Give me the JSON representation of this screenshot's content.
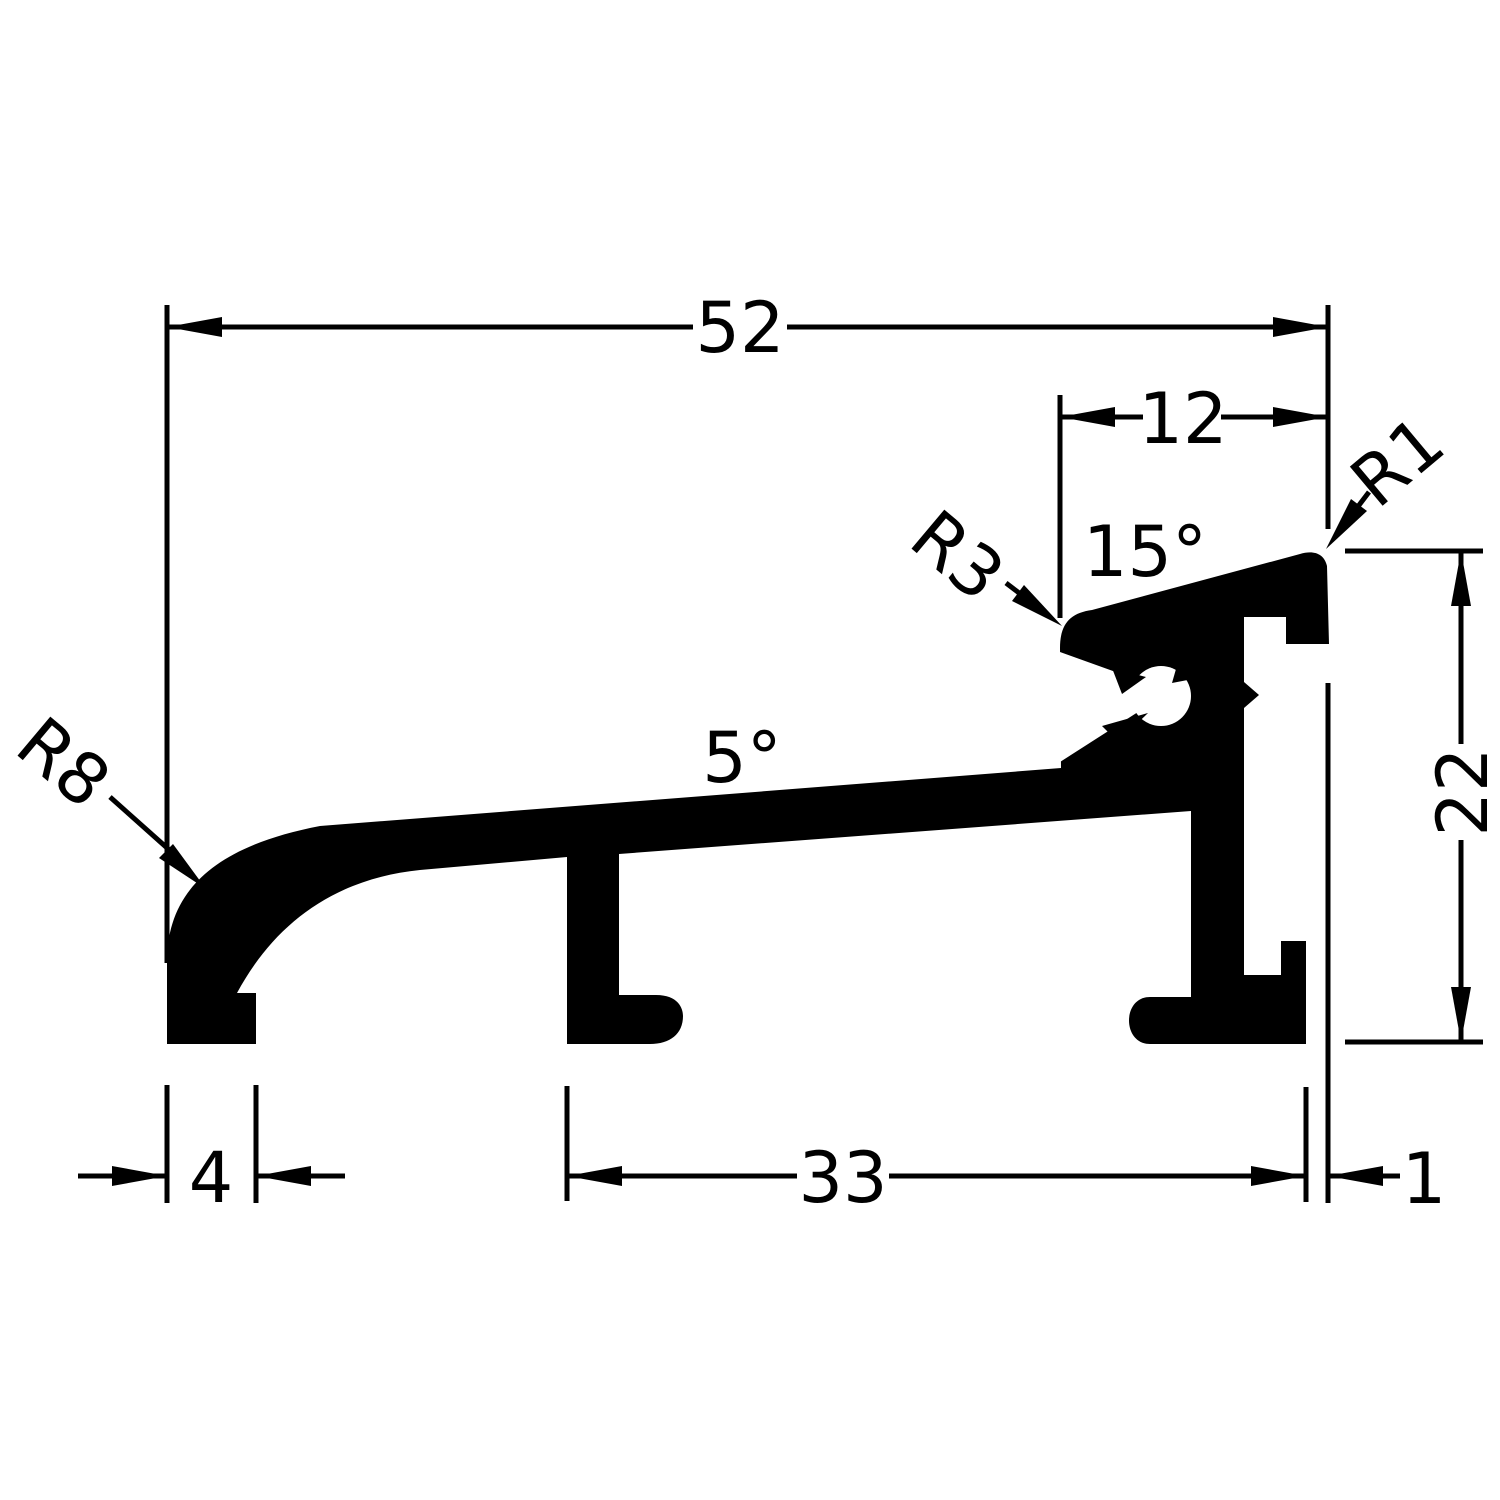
{
  "drawing": {
    "type": "profile-cross-section",
    "colors": {
      "line": "#000000",
      "fill": "#000000",
      "background": "#ffffff"
    },
    "labels": {
      "width_total": "52",
      "width_head": "12",
      "height_right": "22",
      "foot_width": "4",
      "span_middle": "33",
      "offset_right": "1",
      "angle_head": "15°",
      "angle_slope": "5°",
      "radius_nose": "R8",
      "radius_head": "R3",
      "radius_tip": "R1"
    }
  }
}
